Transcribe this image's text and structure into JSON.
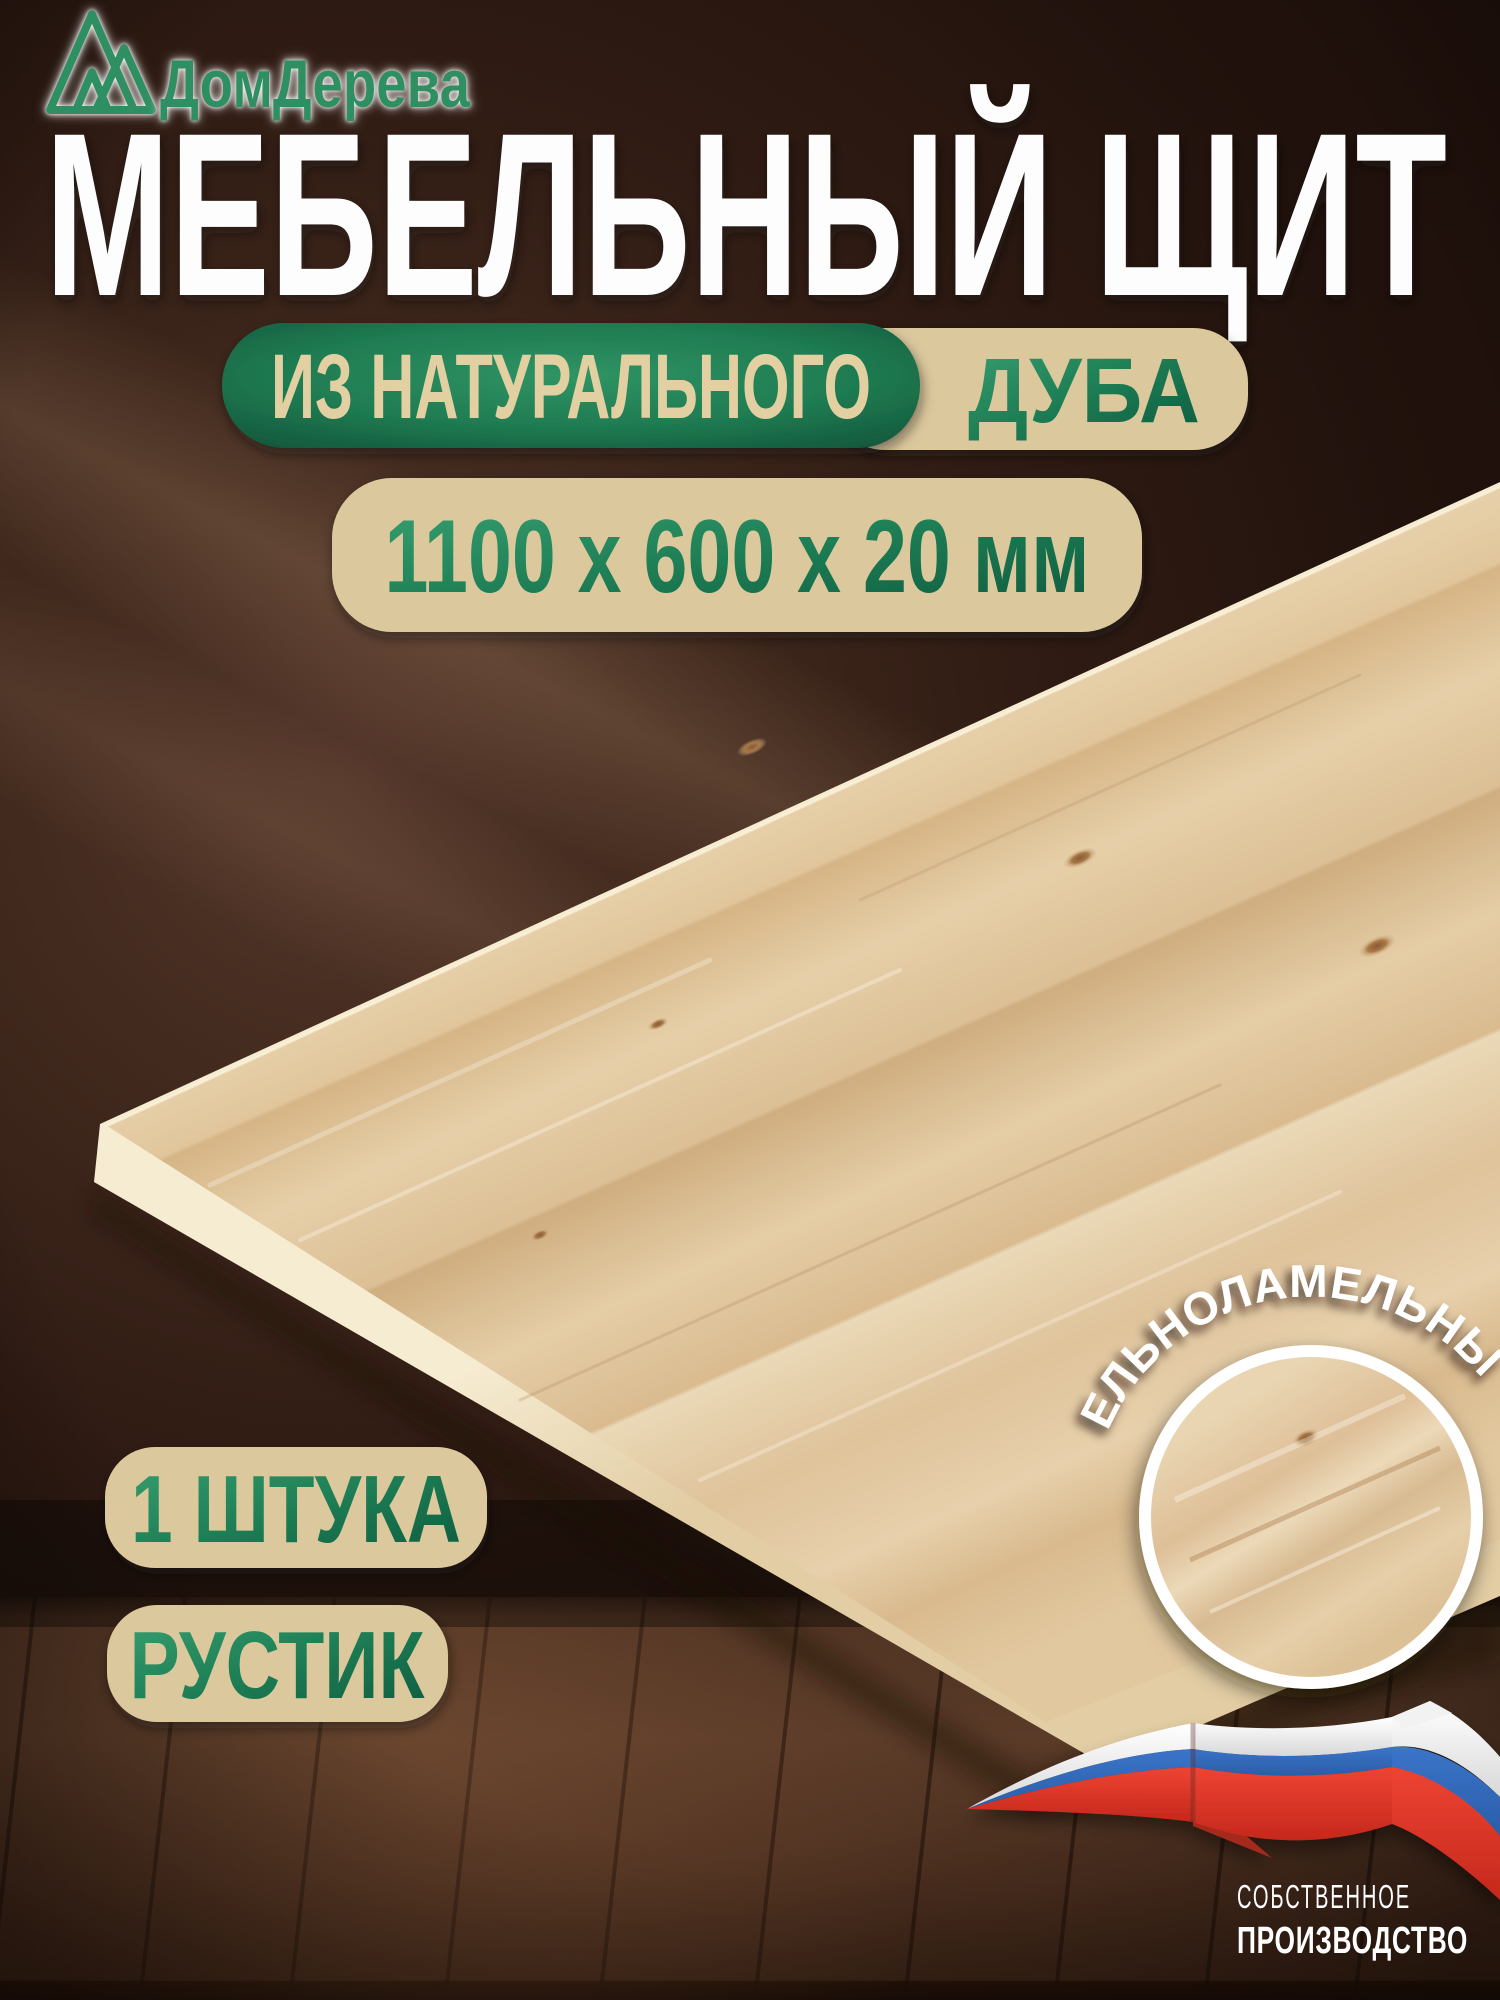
{
  "brand": {
    "name": "ДомДерева"
  },
  "title": "МЕБЕЛЬНЫЙ ЩИТ",
  "badges": {
    "material_prefix": "ИЗ НАТУРАЛЬНОГО",
    "material": "ДУБА",
    "dimensions": "1100 х 600 х 20 мм",
    "quantity": "1 ШТУКА",
    "grade": "РУСТИК",
    "lamella": "ЦЕЛЬНОЛАМЕЛЬНЫЙ"
  },
  "footer": {
    "line1": "СОБСТВЕННОЕ",
    "line2": "ПРОИЗВОДСТВО"
  },
  "icons": {
    "logo": "mountain-monogram-icon",
    "lamella_badge": "wood-texture-circle-icon",
    "flag": "russia-flag-ribbon-icon"
  },
  "colors": {
    "green_dark": "#11543a",
    "green": "#1f7b51",
    "green_bright": "#2f9464",
    "cream_pill": "#dcc89d",
    "title_white": "#fdfdfd",
    "wall_brown": "#3a241c",
    "floor_brown": "#4c2f1f",
    "wood_light": "#e6cfa8",
    "flag_white": "#f7f7f7",
    "flag_blue": "#2f6fc1",
    "flag_red": "#e03a2a"
  }
}
